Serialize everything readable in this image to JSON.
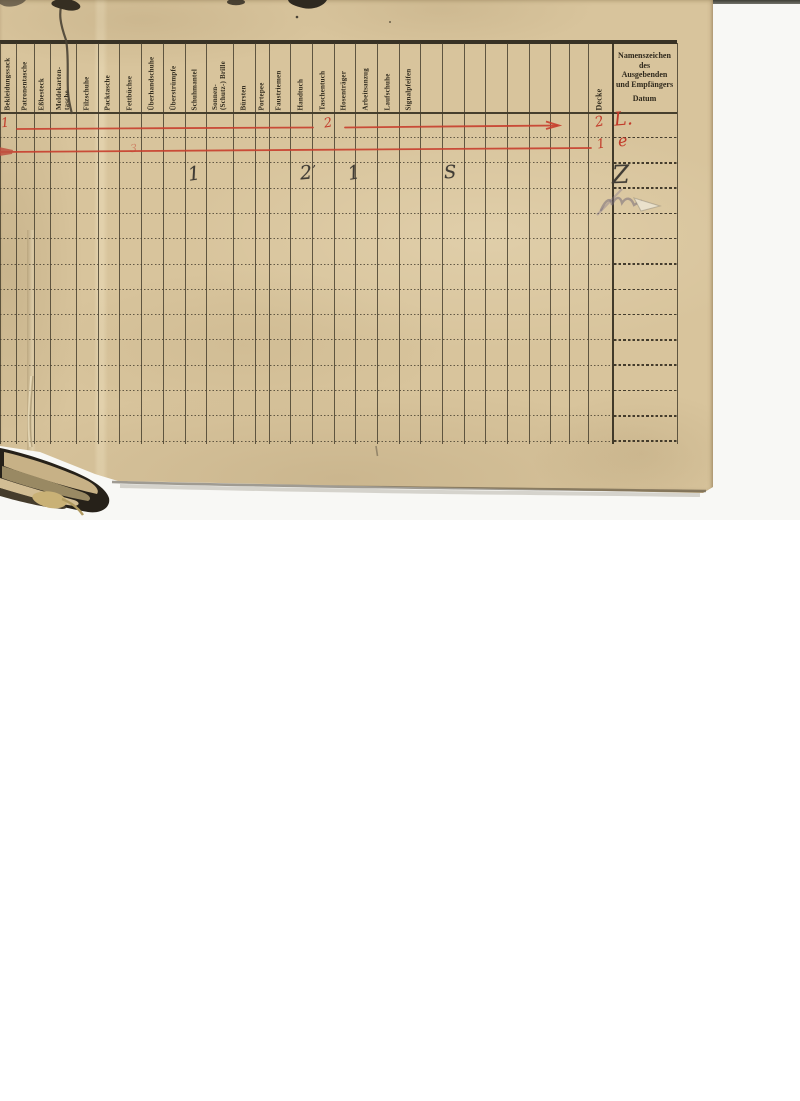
{
  "page": {
    "kind": "scanned ledger page (German clothing/equipment issue register)",
    "language": "de",
    "paper_color": "#d8c49c",
    "ink_color": "#38322d",
    "red_ink_color": "#c23a29",
    "table": {
      "right_edge_x": 677,
      "body_rows": 13,
      "columns": [
        {
          "label": "Bekleidungssack",
          "x": 0,
          "w": 16
        },
        {
          "label": "Patronentasche",
          "x": 16,
          "w": 18
        },
        {
          "label": "Eßbesteck",
          "x": 34,
          "w": 16
        },
        {
          "label": "Meldekarten-\ntasche",
          "x": 50,
          "w": 26
        },
        {
          "label": "Filzschuhe",
          "x": 76,
          "w": 22
        },
        {
          "label": "Packtasche",
          "x": 98,
          "w": 21
        },
        {
          "label": "Fettbüchse",
          "x": 119,
          "w": 22
        },
        {
          "label": "Überhandschuhe",
          "x": 141,
          "w": 22
        },
        {
          "label": "Überstrümpfe",
          "x": 163,
          "w": 22
        },
        {
          "label": "Schuhmantel",
          "x": 185,
          "w": 21
        },
        {
          "label": "Sonnen-\n(Schutz-) Brille",
          "x": 206,
          "w": 27
        },
        {
          "label": "Bürsten",
          "x": 233,
          "w": 22
        },
        {
          "label": "Portepee",
          "x": 255,
          "w": 14
        },
        {
          "label": "Faustriemen",
          "x": 269,
          "w": 21
        },
        {
          "label": "Handtuch",
          "x": 290,
          "w": 22
        },
        {
          "label": "Taschentuch",
          "x": 312,
          "w": 22
        },
        {
          "label": "Hosenträger",
          "x": 334,
          "w": 21
        },
        {
          "label": "Arbeitsanzug",
          "x": 355,
          "w": 22
        },
        {
          "label": "Laufschuhe",
          "x": 377,
          "w": 22
        },
        {
          "label": "Signalpfeifen",
          "x": 399,
          "w": 21
        },
        {
          "label": "",
          "x": 420,
          "w": 22
        },
        {
          "label": "",
          "x": 442,
          "w": 22
        },
        {
          "label": "",
          "x": 464,
          "w": 21
        },
        {
          "label": "",
          "x": 485,
          "w": 22
        },
        {
          "label": "",
          "x": 507,
          "w": 22
        },
        {
          "label": "",
          "x": 529,
          "w": 21
        },
        {
          "label": "",
          "x": 550,
          "w": 19
        },
        {
          "label": "",
          "x": 569,
          "w": 19
        },
        {
          "label": "Decke",
          "x": 588,
          "w": 24,
          "big": true
        },
        {
          "label": "",
          "x": 612,
          "w": 65,
          "type": "namenszeichen"
        }
      ],
      "namenszeichen_header": {
        "lines": [
          "Namenszeichen",
          "des",
          "Ausgebenden",
          "und Empfängers"
        ],
        "datum": "Datum"
      }
    },
    "annotations": {
      "red_texts": [
        {
          "text": "1",
          "x": 1,
          "y": 117,
          "size": 13,
          "rot": -6
        },
        {
          "text": "2",
          "x": 324,
          "y": 117,
          "size": 13,
          "rot": -10
        },
        {
          "text": "3",
          "x": 130,
          "y": 143,
          "size": 11,
          "rot": -4,
          "faint": true
        },
        {
          "text": "2",
          "x": 595,
          "y": 115,
          "size": 14,
          "rot": -12
        },
        {
          "text": "1",
          "x": 597,
          "y": 138,
          "size": 13,
          "rot": -10
        },
        {
          "text": "L.",
          "x": 614,
          "y": 110,
          "size": 19,
          "rot": -5
        },
        {
          "text": "e",
          "x": 618,
          "y": 133,
          "size": 16,
          "rot": -6
        }
      ],
      "red_lines": [
        {
          "x1": 17,
          "y1": 129,
          "x2": 313,
          "y2": 127.5
        },
        {
          "x1": 345,
          "y1": 127.5,
          "x2": 557,
          "y2": 125.5,
          "arrow": true
        },
        {
          "x1": 0,
          "y1": 152,
          "x2": 591,
          "y2": 148,
          "blob_start": true
        }
      ],
      "pencil_texts": [
        {
          "text": "1",
          "x": 188,
          "y": 165,
          "size": 19,
          "rot": -8
        },
        {
          "text": "2",
          "x": 300,
          "y": 164,
          "size": 19,
          "rot": -5
        },
        {
          "text": "’",
          "x": 312,
          "y": 164,
          "size": 12,
          "rot": 0
        },
        {
          "text": "1",
          "x": 348,
          "y": 164,
          "size": 19,
          "rot": -10
        },
        {
          "text": "S",
          "x": 444,
          "y": 164,
          "size": 18,
          "rot": -3
        },
        {
          "text": "Z",
          "x": 612,
          "y": 162,
          "size": 25,
          "rot": -2
        }
      ]
    }
  }
}
